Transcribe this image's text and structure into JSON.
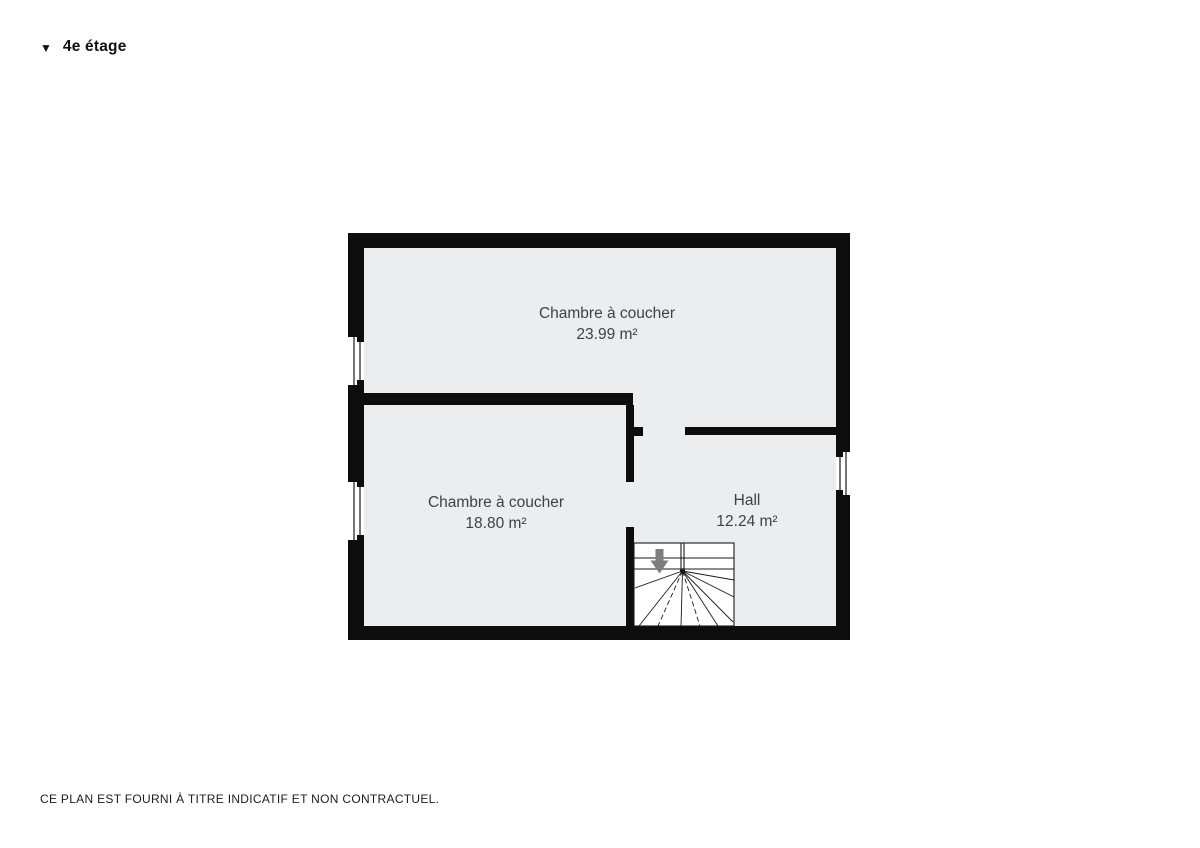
{
  "header": {
    "collapse_icon": "▼",
    "title": "4e étage"
  },
  "plan": {
    "rooms": [
      {
        "name": "Chambre à coucher",
        "area": "23.99 m²"
      },
      {
        "name": "Chambre à coucher",
        "area": "18.80 m²"
      },
      {
        "name": "Hall",
        "area": "12.24 m²"
      }
    ],
    "stairs": {
      "symbol": "winder-staircase",
      "direction": "down"
    }
  },
  "footer": {
    "disclaimer": "CE PLAN EST FOURNI À TITRE INDICATIF ET NON CONTRACTUEL."
  },
  "colors": {
    "wall": "#0d0d0d",
    "floor": "#ECEDEF",
    "room_label": "#3F4143",
    "arrow": "#7D7D7D",
    "window_line": "#1a1a1a"
  }
}
